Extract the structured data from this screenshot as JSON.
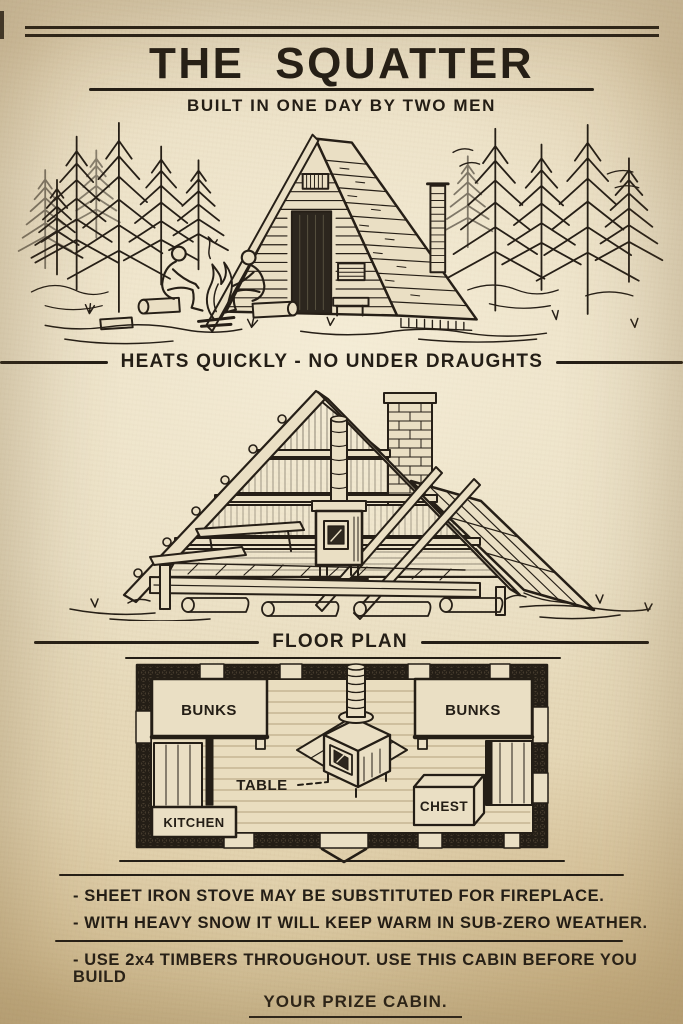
{
  "header": {
    "title": "THE SQUATTER",
    "subtitle": "BUILT IN ONE DAY BY TWO MEN"
  },
  "sections": [
    {
      "caption": "HEATS QUICKLY - NO UNDER DRAUGHTS"
    },
    {
      "caption": "FLOOR PLAN"
    }
  ],
  "floor_plan": {
    "bunks_left": "BUNKS",
    "bunks_right": "BUNKS",
    "table": "TABLE",
    "chest": "CHEST",
    "kitchen": "KITCHEN"
  },
  "notes": [
    "- SHEET IRON STOVE MAY BE SUBSTITUTED FOR FIREPLACE.",
    "- WITH HEAVY SNOW IT WILL KEEP WARM IN SUB-ZERO WEATHER.",
    "- USE 2x4 TIMBERS THROUGHOUT. USE THIS CABIN BEFORE YOU BUILD",
    "YOUR PRIZE CABIN."
  ],
  "colors": {
    "paper": "#e8dcbe",
    "ink": "#241e16"
  }
}
